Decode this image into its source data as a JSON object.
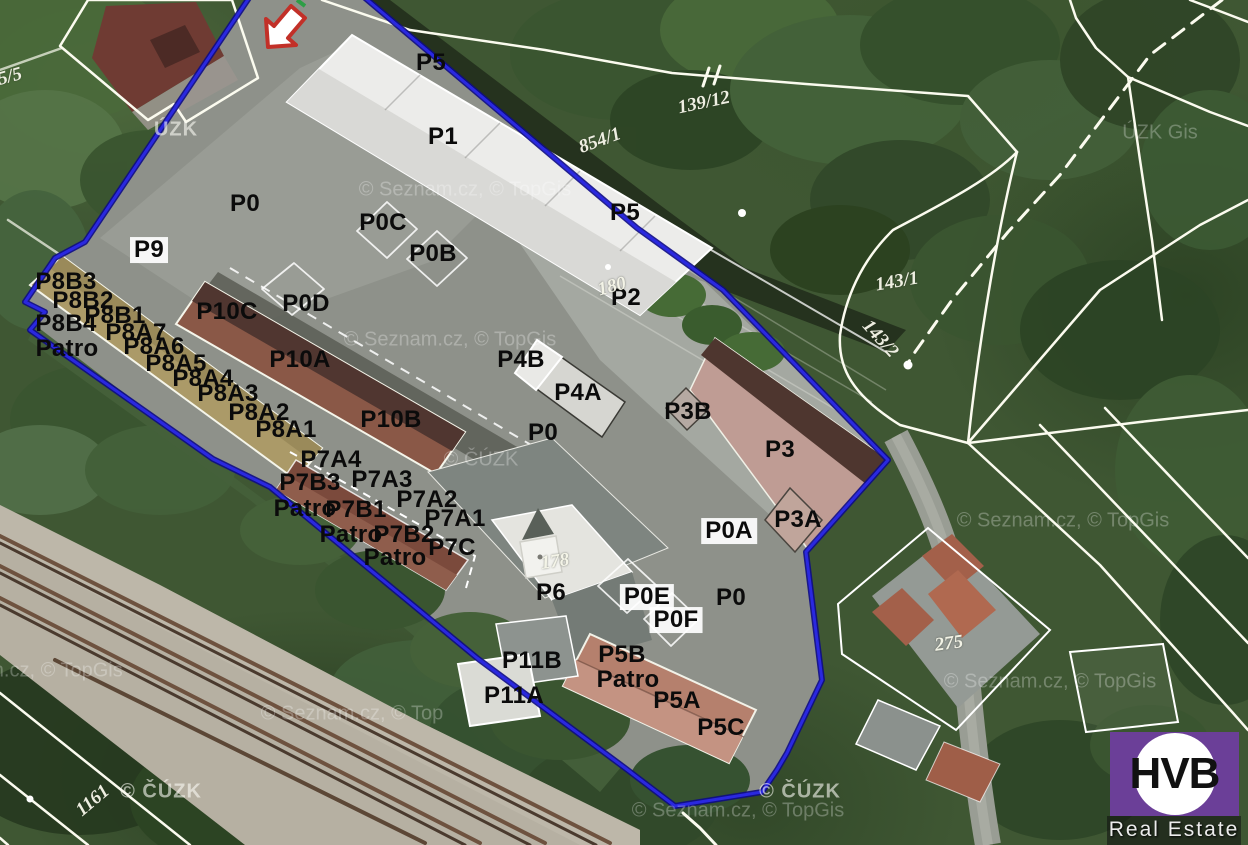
{
  "branding": {
    "logo_abbr": "HVB",
    "logo_name": "Real Estate",
    "logo_bg": "#6b3f98"
  },
  "colors": {
    "boundary_blue": "#1d1ac9",
    "boundary_blue_dark": "#0d0b86",
    "cadastral_white": "#fbfbef",
    "label_black": "#0b0b0b",
    "parcel_text_white": "#f9f9ec",
    "arrow_red": "#c23028",
    "arrow_fill": "#ffffff",
    "roof_white": "#ececea",
    "roof_tan": "#ab9a68",
    "roof_brown_dark": "#503630",
    "roof_brown": "#8a5847",
    "roof_pink": "#bf9c94",
    "roof_salmon": "#b5806d",
    "asphalt_gray": "#8e918a",
    "gravel": "#b6b0a2",
    "vegetation_green": "#3f5733"
  },
  "map": {
    "unit_labels": [
      {
        "text": "P5",
        "x": 431,
        "y": 63
      },
      {
        "text": "P1",
        "x": 443,
        "y": 137
      },
      {
        "text": "P0",
        "x": 245,
        "y": 204
      },
      {
        "text": "P9",
        "x": 149,
        "y": 250,
        "bg": true
      },
      {
        "text": "P0C",
        "x": 383,
        "y": 223
      },
      {
        "text": "P0B",
        "x": 433,
        "y": 254
      },
      {
        "text": "P5",
        "x": 625,
        "y": 213
      },
      {
        "text": "P2",
        "x": 626,
        "y": 298
      },
      {
        "text": "P0D",
        "x": 306,
        "y": 304
      },
      {
        "text": "P10C",
        "x": 227,
        "y": 312
      },
      {
        "text": "P10A",
        "x": 300,
        "y": 360
      },
      {
        "text": "P10B",
        "x": 391,
        "y": 420
      },
      {
        "text": "P8B3",
        "x": 66,
        "y": 282
      },
      {
        "text": "P8B2",
        "x": 83,
        "y": 301
      },
      {
        "text": "P8B1",
        "x": 115,
        "y": 316
      },
      {
        "text": "P8B4",
        "x": 66,
        "y": 324
      },
      {
        "text": "P8A7",
        "x": 136,
        "y": 333
      },
      {
        "text": "Patro",
        "x": 67,
        "y": 349
      },
      {
        "text": "P8A6",
        "x": 154,
        "y": 347
      },
      {
        "text": "P8A5",
        "x": 176,
        "y": 364
      },
      {
        "text": "P8A4",
        "x": 203,
        "y": 379
      },
      {
        "text": "P8A3",
        "x": 228,
        "y": 394
      },
      {
        "text": "P8A2",
        "x": 259,
        "y": 413
      },
      {
        "text": "P8A1",
        "x": 286,
        "y": 430
      },
      {
        "text": "P4B",
        "x": 521,
        "y": 360
      },
      {
        "text": "P4A",
        "x": 578,
        "y": 393
      },
      {
        "text": "P0",
        "x": 543,
        "y": 433
      },
      {
        "text": "P3B",
        "x": 688,
        "y": 412
      },
      {
        "text": "P3",
        "x": 780,
        "y": 450
      },
      {
        "text": "P3A",
        "x": 798,
        "y": 520
      },
      {
        "text": "P0A",
        "x": 729,
        "y": 531,
        "bg": true
      },
      {
        "text": "P7A4",
        "x": 331,
        "y": 460
      },
      {
        "text": "P7B3",
        "x": 310,
        "y": 483
      },
      {
        "text": "P7A3",
        "x": 382,
        "y": 480
      },
      {
        "text": "Patro",
        "x": 305,
        "y": 509
      },
      {
        "text": "P7B1",
        "x": 356,
        "y": 510
      },
      {
        "text": "P7A2",
        "x": 427,
        "y": 500
      },
      {
        "text": "P7A1",
        "x": 455,
        "y": 519
      },
      {
        "text": "Patro",
        "x": 351,
        "y": 535
      },
      {
        "text": "P7B2",
        "x": 404,
        "y": 535
      },
      {
        "text": "P7C",
        "x": 452,
        "y": 548
      },
      {
        "text": "Patro",
        "x": 395,
        "y": 558
      },
      {
        "text": "P6",
        "x": 551,
        "y": 593
      },
      {
        "text": "P0E",
        "x": 647,
        "y": 597,
        "bg": true
      },
      {
        "text": "P0F",
        "x": 676,
        "y": 620,
        "bg": true
      },
      {
        "text": "P0",
        "x": 731,
        "y": 598
      },
      {
        "text": "P11B",
        "x": 532,
        "y": 661
      },
      {
        "text": "P11A",
        "x": 514,
        "y": 696
      },
      {
        "text": "P5B",
        "x": 622,
        "y": 655
      },
      {
        "text": "Patro",
        "x": 628,
        "y": 680
      },
      {
        "text": "P5A",
        "x": 677,
        "y": 701
      },
      {
        "text": "P5C",
        "x": 721,
        "y": 728
      }
    ],
    "parcel_labels": [
      {
        "text": "854/1",
        "x": 600,
        "y": 141,
        "rot": -20
      },
      {
        "text": "139/12",
        "x": 704,
        "y": 103,
        "rot": -12
      },
      {
        "text": "143/1",
        "x": 897,
        "y": 282,
        "rot": -10
      },
      {
        "text": "143/2",
        "x": 880,
        "y": 339,
        "rot": 48
      },
      {
        "text": "180",
        "x": 612,
        "y": 287,
        "rot": -15
      },
      {
        "text": "178",
        "x": 555,
        "y": 562,
        "rot": -8
      },
      {
        "text": "275",
        "x": 949,
        "y": 644,
        "rot": -8
      },
      {
        "text": "1161",
        "x": 93,
        "y": 801,
        "rot": -40
      },
      {
        "text": "5/5",
        "x": 10,
        "y": 77,
        "rot": -15
      }
    ],
    "watermarks": [
      {
        "text": "© Seznam.cz, © TopGis",
        "x": 465,
        "y": 190
      },
      {
        "text": "© Seznam.cz, © TopGis",
        "x": 450,
        "y": 340
      },
      {
        "text": "© ČÚZK",
        "x": 481,
        "y": 460
      },
      {
        "text": "ÚZK",
        "x": 176,
        "y": 130,
        "strong": true
      },
      {
        "text": "ÚZK Gis",
        "x": 1160,
        "y": 133
      },
      {
        "text": "© Seznam.cz, © TopGis",
        "x": 1063,
        "y": 521
      },
      {
        "text": "© Seznam.cz, © TopGis",
        "x": 1050,
        "y": 682
      },
      {
        "text": "© ČÚZK",
        "x": 161,
        "y": 792,
        "strong": true
      },
      {
        "text": "© ČÚZK",
        "x": 800,
        "y": 792,
        "strong": true
      },
      {
        "text": "© Seznam.cz, © TopGis",
        "x": 738,
        "y": 811
      },
      {
        "text": "m.cz, © TopGis",
        "x": 55,
        "y": 671
      },
      {
        "text": "© Seznam.cz, © Top",
        "x": 352,
        "y": 714
      }
    ]
  }
}
